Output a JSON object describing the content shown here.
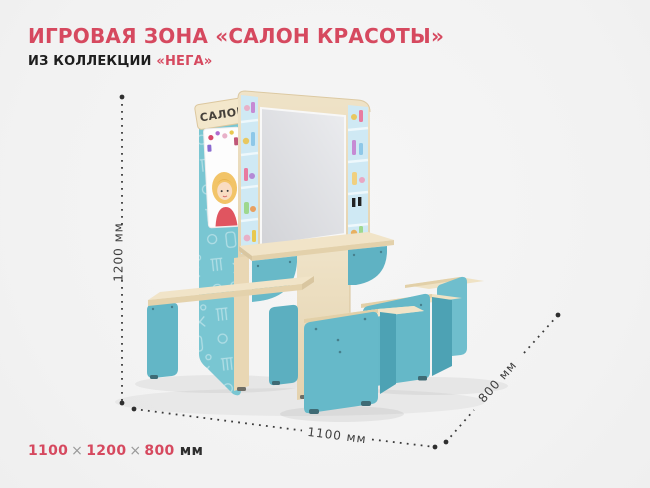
{
  "header": {
    "title": "ИГРОВАЯ ЗОНА «САЛОН КРАСОТЫ»",
    "subtitle_prefix": "ИЗ КОЛЛЕКЦИИ ",
    "collection": "«НЕГА»"
  },
  "product": {
    "sign_text": "САЛОН"
  },
  "dimensions": {
    "height": "1200 мм",
    "width": "1100 мм",
    "depth": "800 мм"
  },
  "footer": {
    "width": "1100",
    "height": "1200",
    "depth": "800",
    "times": "×",
    "unit": " мм"
  },
  "colors": {
    "accent": "#d6495f",
    "teal": "#66b9c9",
    "teal_back_panel": "#79c6d2",
    "wood": "#ecdebe",
    "mirror": "#dfe0e3",
    "background": "#f4f4f4"
  }
}
